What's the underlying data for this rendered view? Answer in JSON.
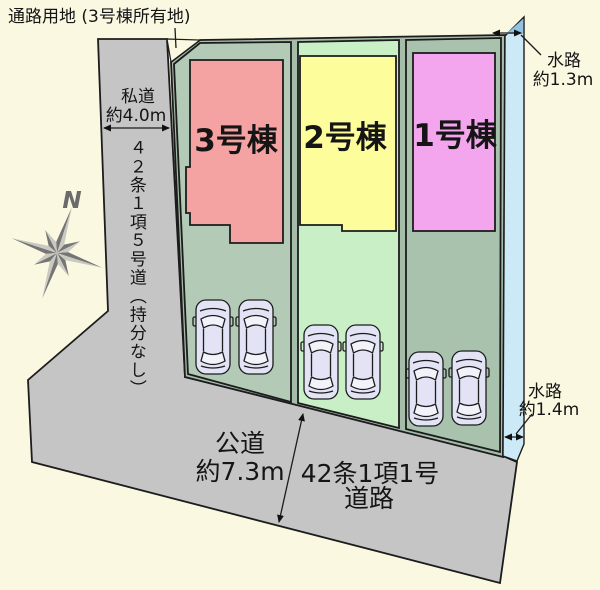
{
  "site_plan": {
    "passage_label": "通路用地 (3号棟所有地)",
    "private_road": {
      "name": "私道",
      "width": "約4.0m"
    },
    "private_road_class": "４２条１項５号道（持分なし）",
    "public_road": {
      "name": "公道",
      "width": "約7.3m"
    },
    "public_road_class": {
      "line1": "42条1項1号",
      "line2": "道路"
    },
    "waterway_top": {
      "name": "水路",
      "width": "約1.3m"
    },
    "waterway_bottom": {
      "name": "水路",
      "width": "約1.4m"
    },
    "compass": {
      "north": "N"
    },
    "buildings": [
      {
        "id": "1",
        "label": "1号棟",
        "fill": "#f3a6ee",
        "text_color": "#5a1b5e",
        "lot_fill": "#a9c2ae"
      },
      {
        "id": "2",
        "label": "2号棟",
        "fill": "#fdfd9b",
        "text_color": "#26261a",
        "lot_fill": "#c9efc7"
      },
      {
        "id": "3",
        "label": "3号棟",
        "fill": "#f5a2a2",
        "text_color": "#6e1616",
        "lot_fill": "#b2cab6"
      }
    ],
    "cars_per_lot": 2,
    "colors": {
      "background": "#fbf8e2",
      "road": "#c5c5c5",
      "parcel_strip": "#a4bca8",
      "waterway": "#cbe9f6",
      "waterway_dark": "#90c2e4",
      "car_body": "#e2e3f4",
      "compass_dark": "#757575",
      "compass_light": "#c9c9c0"
    }
  }
}
